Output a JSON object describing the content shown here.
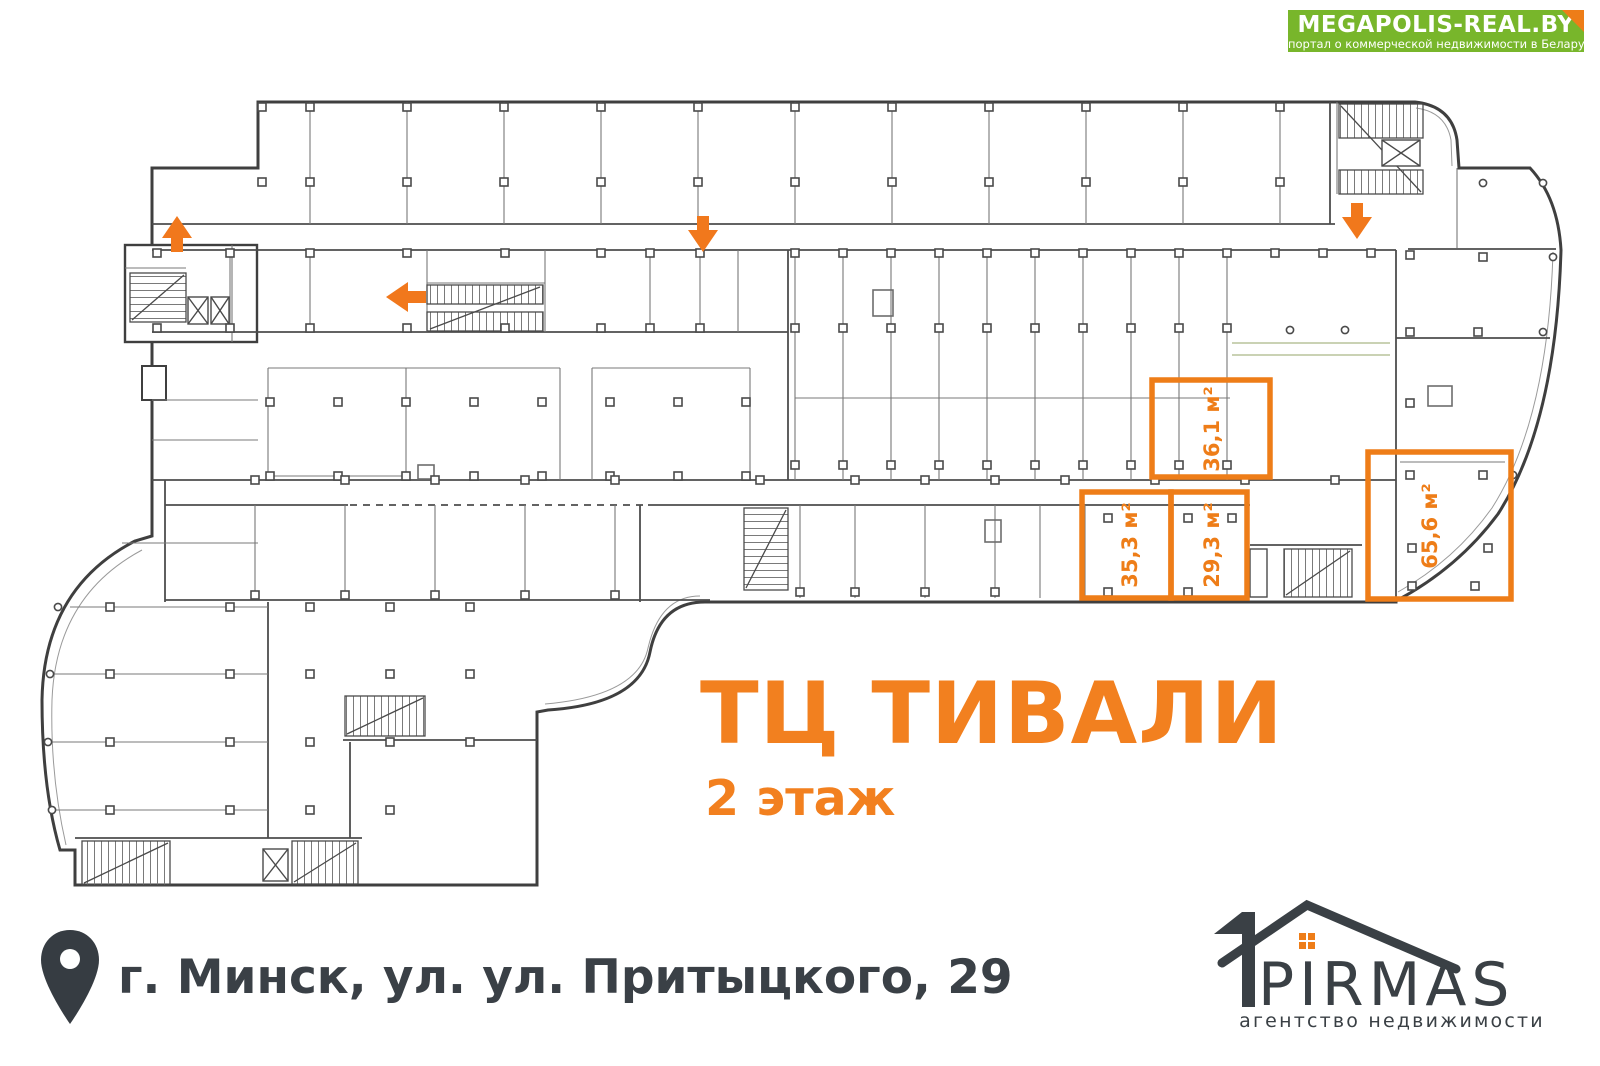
{
  "banner": {
    "title": "MEGAPOLIS-REAL.BY",
    "subtitle": "портал о коммерческой недвижимости в Беларуси"
  },
  "plan": {
    "title": "ТЦ ТИВАЛИ",
    "floor": "2 этаж",
    "units": [
      {
        "id": "unit-36",
        "area": "36,1 м²"
      },
      {
        "id": "unit-35",
        "area": "35,3 м²"
      },
      {
        "id": "unit-29",
        "area": "29,3 м²"
      },
      {
        "id": "unit-65",
        "area": "65,6 м²"
      }
    ]
  },
  "footer": {
    "address": "г. Минск, ул. ул. Притыцкого, 29"
  },
  "agency": {
    "name": "PIRMAS",
    "tagline": "агентство недвижимости"
  },
  "colors": {
    "accent": "#ee7d18",
    "green": "#78b62b",
    "dark": "#3a4045",
    "wall": "#3f3f3f"
  }
}
